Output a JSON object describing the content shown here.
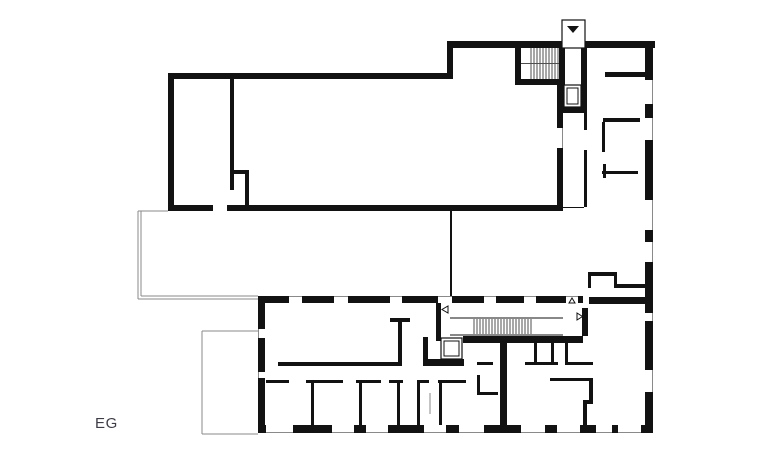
{
  "page": {
    "background": "#ffffff"
  },
  "plan": {
    "floor_label": "EG",
    "kind": "architectural ground-floor plan, black line drawing on white",
    "colors": {
      "wall": "#121212",
      "thin_line": "#8a8a8a",
      "hatch": "#4f4f4f",
      "label": "#3d3d46",
      "background": "#ffffff"
    },
    "features": {
      "entrance_marker": "small white box on north facade with filled triangle pointing down (entrance arrow)",
      "stairs": [
        "upper stair with tread hatching beside entrance",
        "long corridor stair with tread hatching in south wing"
      ],
      "elevators": [
        "lift shaft below entrance stair",
        "lift shaft in south-wing corridor"
      ],
      "terraces": [
        "west glazed hall front (thin double line)",
        "south-west patio (thin outline)"
      ],
      "door_swing_markers": [
        "left-pointing",
        "up-pointing",
        "right-pointing"
      ],
      "windows": "thick facade walls interrupted by white window openings with a continuous thin face line"
    }
  }
}
